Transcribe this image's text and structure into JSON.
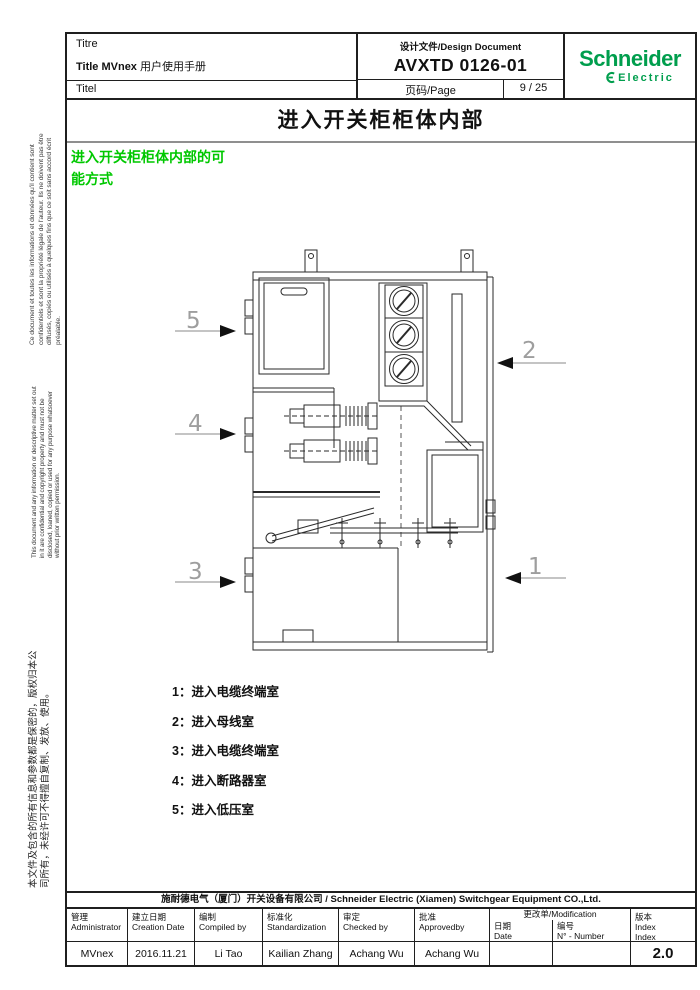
{
  "colors": {
    "schneider_green": "#009E4D",
    "heading_green": "#00C800"
  },
  "header": {
    "titre": "Titre",
    "title_en": "Title MVnex",
    "title_cn": " 用户使用手册",
    "titel": "Titel",
    "doc_type": "设计文件/Design Document",
    "doc_number": "AVXTD 0126-01",
    "page_label": "页码/Page",
    "page_value": "9 / 25",
    "logo_line1": "Schneider",
    "logo_line2": "Electric"
  },
  "sidebar": {
    "french": "Ce document et toutes les informations et données qu'il contient sont confidentiels et sont la propriété légale de l'auteur. Ils ne doivent pas être diffusés, copiés ou utilisés à quelques fins que ce soit sans accord écrit préalable.",
    "english": "This document and any information or descriptive matter set out in it are confidential and copyright property and must not be disclosed, loaned, copied or used for any purpose whatsoever without prior written permission.",
    "chinese": "本文件及包含的所有信息和参数都是保密的，版权归本公司所有，未经许可不得擅自复制、发放、使用。"
  },
  "main": {
    "title": "进入开关柜柜体内部",
    "section_heading": {
      "line1": "进入开关柜柜体内部的可",
      "line2": "能方式"
    },
    "callouts": [
      "1",
      "2",
      "3",
      "4",
      "5"
    ],
    "legend": [
      {
        "label": "1：",
        "text": "进入电缆终端室"
      },
      {
        "label": "2：",
        "text": "进入母线室"
      },
      {
        "label": "3：",
        "text": "进入电缆终端室"
      },
      {
        "label": "4：",
        "text": "进入断路器室"
      },
      {
        "label": "5：",
        "text": "进入低压室"
      }
    ]
  },
  "footer": {
    "company": "施耐德电气（厦门）开关设备有限公司 / Schneider Electric  (Xiamen) Switchgear Equipment CO.,Ltd.",
    "columns": [
      {
        "zh": "管理",
        "en": "Administrator",
        "value": "MVnex"
      },
      {
        "zh": "建立日期",
        "en": "Creation Date",
        "value": "2016.11.21"
      },
      {
        "zh": "编制",
        "en": "Compiled by",
        "value": "Li Tao"
      },
      {
        "zh": "标准化",
        "en": "Standardization",
        "value": "Kailian Zhang"
      },
      {
        "zh": "审定",
        "en": "Checked by",
        "value": "Achang Wu"
      },
      {
        "zh": "批准",
        "en": "Approvedby",
        "value": "Achang Wu"
      }
    ],
    "modification": {
      "title": "更改单/Modification",
      "date_zh": "日期",
      "date_en": "Date",
      "date_value": "",
      "num_zh": "编号",
      "num_en": "N° - Number",
      "num_value": ""
    },
    "version": {
      "zh": "版本",
      "en1": "Index",
      "en2": "Index",
      "value": "2.0"
    }
  }
}
